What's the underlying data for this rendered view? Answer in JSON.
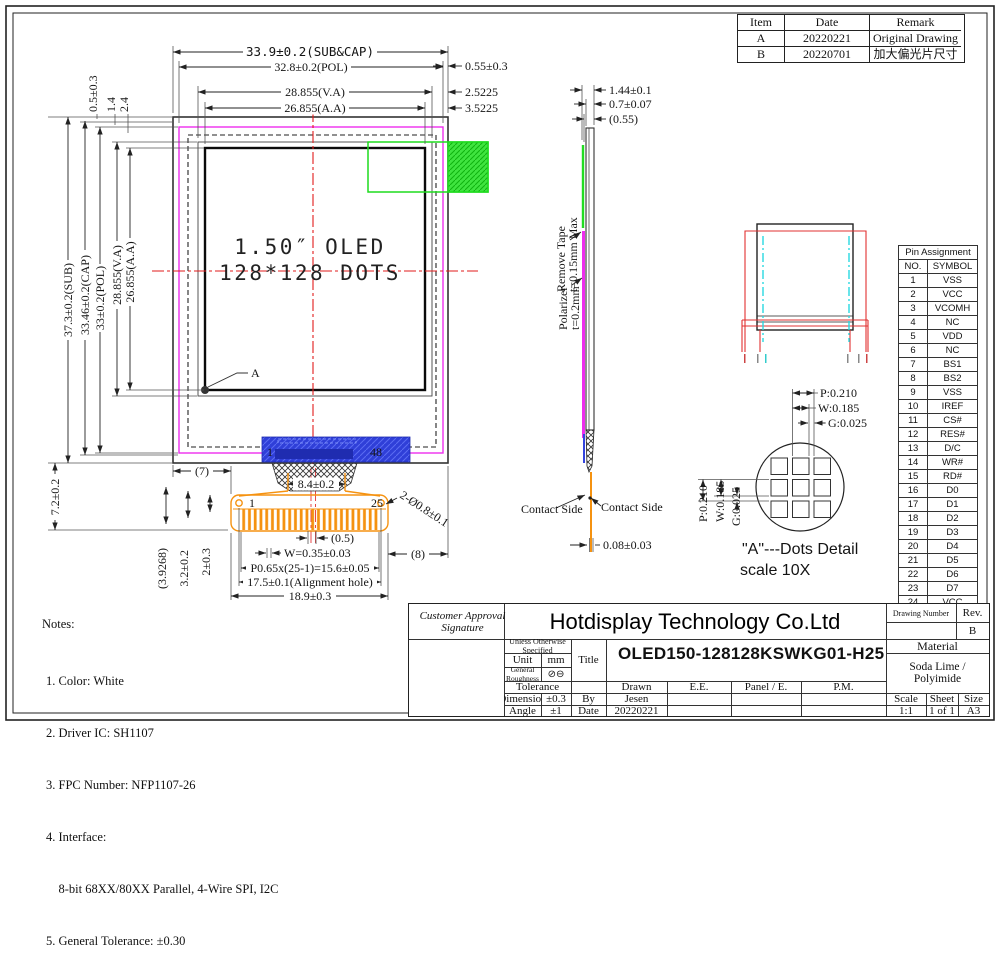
{
  "revision_table": {
    "headers": [
      "Item",
      "Date",
      "Remark"
    ],
    "rows": [
      [
        "A",
        "20220221",
        "Original Drawing"
      ],
      [
        "B",
        "20220701",
        "加大偏光片尺寸"
      ]
    ]
  },
  "front_view": {
    "line1": "1.50″ OLED",
    "line2": "128*128 DOTS",
    "corner_label": "A",
    "ic_first": "1",
    "ic_last": "48",
    "fpc_first": "1",
    "fpc_last": "25",
    "dims_top": {
      "sub_cap": "33.9±0.2(SUB&CAP)",
      "pol": "32.8±0.2(POL)",
      "va": "28.855(V.A)",
      "aa": "26.855(A.A)",
      "right1": "0.55±0.3",
      "right2": "2.5225",
      "right3": "3.5225"
    },
    "dims_left": {
      "d05": "0.5±0.3",
      "d14": "1.4",
      "d24": "2.4",
      "sub": "37.3±0.2(SUB)",
      "cap": "33.46±0.2(CAP)",
      "pol": "33±0.2(POL)",
      "va": "28.855(V.A)",
      "aa": "26.855(A.A)",
      "tail": "7.2±0.2"
    },
    "dims_bottom": {
      "b1": "(7)",
      "b2": "8.4±0.2",
      "b3": "2-Ø0.8±0.1",
      "b4": "(0.5)",
      "b5": "W=0.35±0.03",
      "b6": "P0.65x(25-1)=15.6±0.05",
      "b7": "17.5±0.1(Alignment hole)",
      "b8": "18.9±0.3",
      "b9": "(8)",
      "b10": "2±0.3",
      "b11": "3.2±0.2",
      "b12": "(3.9268)"
    }
  },
  "side_view": {
    "d1": "1.44±0.1",
    "d2": "0.7±0.07",
    "d3": "(0.55)",
    "tape1": "Remove Tape",
    "tape2": "t=0.15mm Max",
    "pol1": "Polarizer",
    "pol2": "t=0.2mm",
    "contact_left": "Contact Side",
    "contact_right": "Contact Side",
    "d4": "0.08±0.03"
  },
  "dots_detail": {
    "p": "P:0.210",
    "w": "W:0.185",
    "g": "G:0.025",
    "p2": "P:0.210",
    "w2": "W:0.185",
    "g2": "G:0.025",
    "caption1": "\"A\"---Dots Detail",
    "caption2": "scale 10X"
  },
  "pin_table": {
    "title": "Pin Assignment",
    "col_no": "NO.",
    "col_symbol": "SYMBOL",
    "rows": [
      {
        "no": "1",
        "symbol": "VSS"
      },
      {
        "no": "2",
        "symbol": "VCC"
      },
      {
        "no": "3",
        "symbol": "VCOMH"
      },
      {
        "no": "4",
        "symbol": "NC"
      },
      {
        "no": "5",
        "symbol": "VDD"
      },
      {
        "no": "6",
        "symbol": "NC"
      },
      {
        "no": "7",
        "symbol": "BS1"
      },
      {
        "no": "8",
        "symbol": "BS2"
      },
      {
        "no": "9",
        "symbol": "VSS"
      },
      {
        "no": "10",
        "symbol": "IREF"
      },
      {
        "no": "11",
        "symbol": "CS#"
      },
      {
        "no": "12",
        "symbol": "RES#"
      },
      {
        "no": "13",
        "symbol": "D/C"
      },
      {
        "no": "14",
        "symbol": "WR#"
      },
      {
        "no": "15",
        "symbol": "RD#"
      },
      {
        "no": "16",
        "symbol": "D0"
      },
      {
        "no": "17",
        "symbol": "D1"
      },
      {
        "no": "18",
        "symbol": "D2"
      },
      {
        "no": "19",
        "symbol": "D3"
      },
      {
        "no": "20",
        "symbol": "D4"
      },
      {
        "no": "21",
        "symbol": "D5"
      },
      {
        "no": "22",
        "symbol": "D6"
      },
      {
        "no": "23",
        "symbol": "D7"
      },
      {
        "no": "24",
        "symbol": "VCC"
      },
      {
        "no": "25",
        "symbol": "VSS"
      }
    ]
  },
  "notes": {
    "title": "Notes:",
    "lines": [
      "1. Color: White",
      "2. Driver IC: SH1107",
      "3. FPC Number: NFP1107-26",
      "4. Interface:",
      "    8-bit 68XX/80XX Parallel, 4-Wire SPI, I2C",
      "5. General Tolerance: ±0.30"
    ]
  },
  "title_block": {
    "customer_approval": "Customer Approval Signature",
    "company": "Hotdisplay Technology Co.Ltd",
    "drawing_number_label": "Drawing Number",
    "rev_label": "Rev.",
    "rev_value": "B",
    "spec_header": "Unless Otherwise Specified",
    "unit_label": "Unit",
    "unit_value": "mm",
    "roughness_label": "General Roughness",
    "roughness_symbol": "⊘⊖",
    "tolerance_label": "Tolerance",
    "dimension_label": "Dimension",
    "dimension_value": "±0.3",
    "angle_label": "Angle",
    "angle_value": "±1",
    "title_label": "Title",
    "title_value": "OLED150-128128KSWKG01-H25",
    "by_label": "By",
    "date_label": "Date",
    "drawn_label": "Drawn",
    "ee_label": "E.E.",
    "panel_label": "Panel / E.",
    "pm_label": "P.M.",
    "drawn_value": "Jesen",
    "date_value": "20220221",
    "material_label": "Material",
    "material_value": "Soda Lime / Polyimide",
    "scale_label": "Scale",
    "sheet_label": "Sheet",
    "size_label": "Size",
    "scale_value": "1:1",
    "sheet_value": "1 of 1",
    "size_value": "A3"
  },
  "colors": {
    "centerline_red": "#e21b1b",
    "polarizer_magenta": "#ee2dee",
    "tape_green": "#22dd22",
    "cyan": "#29d8e0",
    "fpc_orange": "#f59210",
    "ic_blue": "#2f3fd8"
  }
}
